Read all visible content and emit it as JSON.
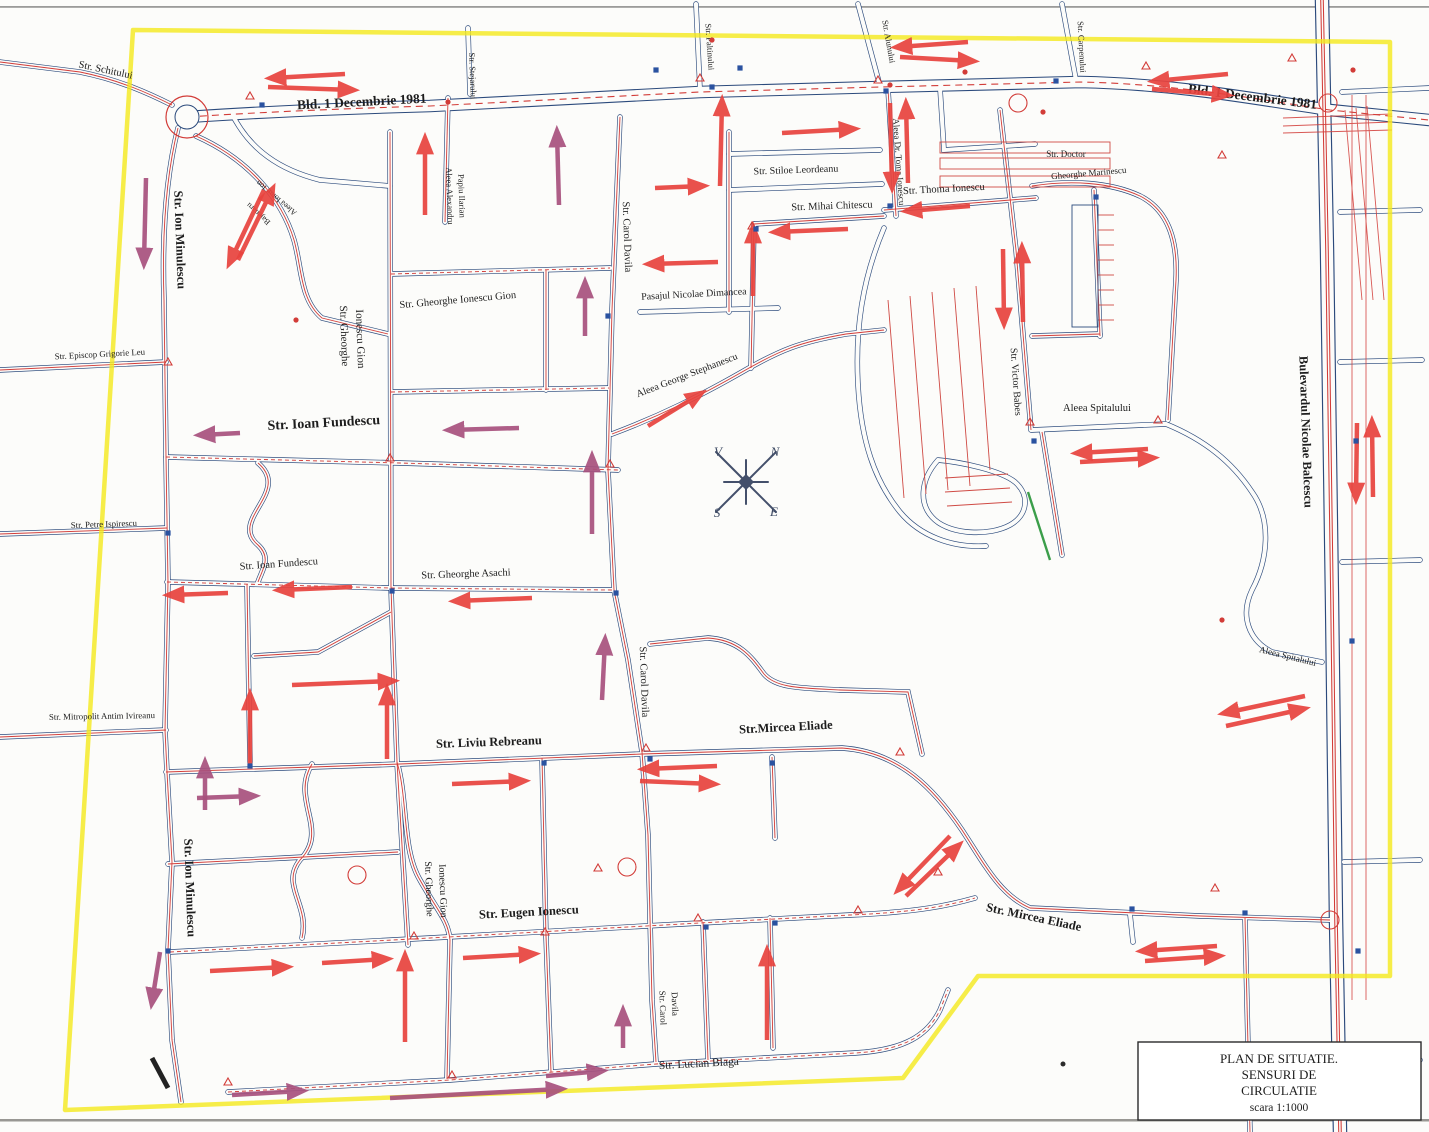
{
  "title_block": {
    "line1": "PLAN DE SITUATIE.",
    "line2": "SENSURI DE",
    "line3": "CIRCULATIE",
    "line4": "scara 1:1000"
  },
  "compass": {
    "north": "N",
    "east": "E",
    "south": "S",
    "west": "V"
  },
  "colors": {
    "boundary_highlight": "#f4e81c",
    "road_casing": "#2b4a7c",
    "road_axis_red": "#d23c38",
    "arrow_red": "#e8433e",
    "arrow_purple": "#a8517e",
    "green_marking": "#3b9e4a",
    "paper": "#fcfcfa"
  },
  "labels": [
    {
      "t": "Str. Schitului",
      "x": 105,
      "y": 73,
      "r": 12,
      "s": 10.5
    },
    {
      "t": "Bld. 1 Decembrie 1981",
      "x": 362,
      "y": 106,
      "r": -3,
      "s": 13.5
    },
    {
      "t": "Bld. 1 Decembrie 1981",
      "x": 1252,
      "y": 101,
      "r": 7,
      "s": 13.5
    },
    {
      "t": "Str. Stejarului",
      "x": 470,
      "y": 76,
      "r": 88,
      "s": 8.5
    },
    {
      "t": "Aleea Alexandru",
      "x": 447,
      "y": 196,
      "r": 88,
      "s": 8.5
    },
    {
      "t": "Papiu Ilarian",
      "x": 459,
      "y": 196,
      "r": 88,
      "s": 8.5
    },
    {
      "t": "Aleea Ionut Ion",
      "x": 278,
      "y": 196,
      "r": 220,
      "s": 8
    },
    {
      "t": "Bajenaru",
      "x": 260,
      "y": 212,
      "r": 222,
      "s": 8
    },
    {
      "t": "Str. Ion Minulescu",
      "x": 176,
      "y": 240,
      "r": 88,
      "s": 12.5
    },
    {
      "t": "Str. Ion Minulescu",
      "x": 186,
      "y": 888,
      "r": 88,
      "s": 12.5
    },
    {
      "t": "Str. Episcop Grigorie Leu",
      "x": 100,
      "y": 357,
      "r": -3,
      "s": 8.8
    },
    {
      "t": "Str. Petre Ispirescu",
      "x": 104,
      "y": 527,
      "r": -2,
      "s": 8.8
    },
    {
      "t": "Str. Mitropolit Antim Ivireanu",
      "x": 102,
      "y": 719,
      "r": -1,
      "s": 8.8
    },
    {
      "t": "Str. Ioan Fundescu",
      "x": 324,
      "y": 427,
      "r": -3,
      "s": 14
    },
    {
      "t": "Str. Ioan Fundescu",
      "x": 279,
      "y": 567,
      "r": -4,
      "s": 10.5
    },
    {
      "t": "Str. Gheorghe Asachi",
      "x": 466,
      "y": 577,
      "r": -2,
      "s": 10.5
    },
    {
      "t": "Str. Gheorghe",
      "x": 341,
      "y": 336,
      "r": 88,
      "s": 11
    },
    {
      "t": "Ionescu Gion",
      "x": 357,
      "y": 339,
      "r": 88,
      "s": 11
    },
    {
      "t": "Str. Gheorghe Ionescu Gion",
      "x": 458,
      "y": 303,
      "r": -5,
      "s": 10.5
    },
    {
      "t": "Str. Carol Davila",
      "x": 624,
      "y": 237,
      "r": 88,
      "s": 10.5
    },
    {
      "t": "Str. Carol Davila",
      "x": 641,
      "y": 682,
      "r": 88,
      "s": 10.5
    },
    {
      "t": "Str. Carol",
      "x": 660,
      "y": 1008,
      "r": 88,
      "s": 9
    },
    {
      "t": "Davila",
      "x": 672,
      "y": 1004,
      "r": 88,
      "s": 9
    },
    {
      "t": "Pasajul Nicolae Dimancea",
      "x": 694,
      "y": 297,
      "r": -3,
      "s": 10
    },
    {
      "t": "Aleea George Stephanescu",
      "x": 688,
      "y": 378,
      "r": -21,
      "s": 10
    },
    {
      "t": "Str. Stiloe Leordeanu",
      "x": 796,
      "y": 173,
      "r": -2,
      "s": 10
    },
    {
      "t": "Str. Mihai Chitescu",
      "x": 832,
      "y": 209,
      "r": -2,
      "s": 10.5
    },
    {
      "t": "Aleea Dr. Toma Ionescu",
      "x": 896,
      "y": 162,
      "r": 86,
      "s": 9
    },
    {
      "t": "Str. Thoma Ionescu",
      "x": 944,
      "y": 192,
      "r": -3,
      "s": 10.5
    },
    {
      "t": "Str. Doctor",
      "x": 1066,
      "y": 157,
      "r": 0,
      "s": 9
    },
    {
      "t": "Gheorghe Marinescu",
      "x": 1089,
      "y": 176,
      "r": -5,
      "s": 9
    },
    {
      "t": "Str. Victor Babes",
      "x": 1013,
      "y": 382,
      "r": 86,
      "s": 10
    },
    {
      "t": "Aleea Spitalului",
      "x": 1097,
      "y": 411,
      "r": 0,
      "s": 10.5
    },
    {
      "t": "Aleea Spitalului",
      "x": 1287,
      "y": 659,
      "r": 14,
      "s": 9
    },
    {
      "t": "Bulevardul Nicolae Balcescu",
      "x": 1302,
      "y": 432,
      "r": 88,
      "s": 12.5
    },
    {
      "t": "Str. Liviu Rebreanu",
      "x": 489,
      "y": 746,
      "r": -2,
      "s": 12.5
    },
    {
      "t": "Str.Mircea Eliade",
      "x": 786,
      "y": 731,
      "r": -3,
      "s": 12.5
    },
    {
      "t": "Str. Mircea Eliade",
      "x": 1033,
      "y": 921,
      "r": 12,
      "s": 12.5
    },
    {
      "t": "Str. Eugen Ionescu",
      "x": 529,
      "y": 916,
      "r": -3,
      "s": 12.5
    },
    {
      "t": "Str. Gheorghe",
      "x": 426,
      "y": 889,
      "r": 88,
      "s": 10
    },
    {
      "t": "Ionescu Gion",
      "x": 440,
      "y": 891,
      "r": 88,
      "s": 10
    },
    {
      "t": "Str. Lucian Blaga",
      "x": 699,
      "y": 1067,
      "r": -3,
      "s": 11.5
    },
    {
      "t": "Str. Paltinului",
      "x": 707,
      "y": 47,
      "r": 86,
      "s": 8.5
    },
    {
      "t": "Str. Alunului",
      "x": 886,
      "y": 42,
      "r": 80,
      "s": 8.5
    },
    {
      "t": "Str. Carpenului",
      "x": 1079,
      "y": 47,
      "r": 87,
      "s": 8.5
    }
  ],
  "arrows": [
    [
      345,
      74,
      272,
      78,
      "r"
    ],
    [
      268,
      87,
      352,
      90,
      "r"
    ],
    [
      968,
      42,
      898,
      47,
      "r"
    ],
    [
      900,
      57,
      972,
      61,
      "r"
    ],
    [
      1228,
      74,
      1155,
      81,
      "r"
    ],
    [
      1152,
      89,
      1226,
      95,
      "r"
    ],
    [
      264,
      190,
      230,
      262,
      "r"
    ],
    [
      238,
      260,
      272,
      190,
      "r"
    ],
    [
      146,
      178,
      144,
      262,
      "p"
    ],
    [
      425,
      215,
      425,
      140,
      "r"
    ],
    [
      559,
      205,
      557,
      133,
      "p"
    ],
    [
      655,
      188,
      702,
      186,
      "r"
    ],
    [
      718,
      262,
      650,
      264,
      "r"
    ],
    [
      782,
      133,
      853,
      129,
      "r"
    ],
    [
      970,
      206,
      908,
      211,
      "r"
    ],
    [
      848,
      229,
      776,
      232,
      "r"
    ],
    [
      753,
      296,
      753,
      229,
      "r"
    ],
    [
      890,
      103,
      892,
      186,
      "r"
    ],
    [
      908,
      183,
      906,
      105,
      "r"
    ],
    [
      720,
      186,
      722,
      102,
      "r"
    ],
    [
      1003,
      249,
      1004,
      322,
      "r"
    ],
    [
      1023,
      322,
      1022,
      249,
      "r"
    ],
    [
      648,
      426,
      700,
      394,
      "r"
    ],
    [
      585,
      336,
      585,
      284,
      "p"
    ],
    [
      519,
      428,
      450,
      430,
      "p"
    ],
    [
      240,
      433,
      201,
      435,
      "p"
    ],
    [
      228,
      593,
      170,
      595,
      "r"
    ],
    [
      352,
      587,
      280,
      590,
      "r"
    ],
    [
      532,
      598,
      456,
      601,
      "r"
    ],
    [
      292,
      685,
      392,
      681,
      "r"
    ],
    [
      250,
      766,
      250,
      696,
      "r"
    ],
    [
      387,
      759,
      387,
      691,
      "r"
    ],
    [
      197,
      798,
      253,
      796,
      "p"
    ],
    [
      452,
      784,
      523,
      781,
      "r"
    ],
    [
      717,
      766,
      645,
      769,
      "r"
    ],
    [
      640,
      781,
      713,
      784,
      "r"
    ],
    [
      602,
      700,
      605,
      641,
      "p"
    ],
    [
      592,
      534,
      592,
      458,
      "p"
    ],
    [
      950,
      836,
      899,
      889,
      "r"
    ],
    [
      906,
      896,
      958,
      846,
      "r"
    ],
    [
      1148,
      449,
      1078,
      453,
      "r"
    ],
    [
      1080,
      462,
      1152,
      458,
      "r"
    ],
    [
      1305,
      696,
      1225,
      713,
      "r"
    ],
    [
      1226,
      726,
      1303,
      709,
      "r"
    ],
    [
      1357,
      423,
      1356,
      497,
      "r"
    ],
    [
      1373,
      497,
      1372,
      423,
      "r"
    ],
    [
      1217,
      946,
      1143,
      951,
      "r"
    ],
    [
      1145,
      961,
      1218,
      956,
      "r"
    ],
    [
      405,
      1042,
      405,
      957,
      "r"
    ],
    [
      623,
      1048,
      623,
      1012,
      "p"
    ],
    [
      767,
      1040,
      767,
      952,
      "r"
    ],
    [
      232,
      1095,
      301,
      1091,
      "p"
    ],
    [
      390,
      1098,
      560,
      1089,
      "p"
    ],
    [
      546,
      1076,
      601,
      1071,
      "p"
    ],
    [
      160,
      952,
      152,
      1002,
      "p"
    ],
    [
      205,
      810,
      205,
      764,
      "p"
    ],
    [
      463,
      958,
      533,
      954,
      "r"
    ],
    [
      210,
      971,
      286,
      967,
      "r"
    ],
    [
      322,
      963,
      386,
      959,
      "r"
    ]
  ],
  "signs": [
    [
      "tri",
      250,
      96
    ],
    [
      "tri",
      700,
      78
    ],
    [
      "tri",
      878,
      80
    ],
    [
      "tri",
      1146,
      66
    ],
    [
      "tri",
      1292,
      58
    ],
    [
      "tri",
      168,
      362
    ],
    [
      "tri",
      390,
      458
    ],
    [
      "tri",
      610,
      464
    ],
    [
      "tri",
      646,
      748
    ],
    [
      "tri",
      900,
      752
    ],
    [
      "tri",
      1030,
      422
    ],
    [
      "tri",
      1158,
      420
    ],
    [
      "tri",
      414,
      936
    ],
    [
      "tri",
      545,
      932
    ],
    [
      "tri",
      698,
      918
    ],
    [
      "tri",
      858,
      910
    ],
    [
      "tri",
      228,
      1082
    ],
    [
      "tri",
      452,
      1075
    ],
    [
      "tri",
      752,
      226
    ],
    [
      "tri",
      1222,
      155
    ],
    [
      "tri",
      598,
      868
    ],
    [
      "tri",
      938,
      872
    ],
    [
      "tri",
      1215,
      888
    ],
    [
      "sq",
      262,
      105
    ],
    [
      "sq",
      712,
      87
    ],
    [
      "sq",
      886,
      91
    ],
    [
      "sq",
      1056,
      81
    ],
    [
      "sq",
      168,
      533
    ],
    [
      "sq",
      392,
      591
    ],
    [
      "sq",
      616,
      593
    ],
    [
      "sq",
      650,
      759
    ],
    [
      "sq",
      772,
      763
    ],
    [
      "sq",
      1034,
      441
    ],
    [
      "sq",
      544,
      763
    ],
    [
      "sq",
      706,
      927
    ],
    [
      "sq",
      775,
      923
    ],
    [
      "sq",
      1245,
      913
    ],
    [
      "sq",
      1132,
      909
    ],
    [
      "sq",
      168,
      951
    ],
    [
      "sq",
      250,
      766
    ],
    [
      "sq",
      608,
      316
    ],
    [
      "sq",
      756,
      229
    ],
    [
      "sq",
      890,
      206
    ],
    [
      "sq",
      1096,
      197
    ],
    [
      "sq",
      1358,
      951
    ],
    [
      "sq",
      1356,
      441
    ],
    [
      "sq",
      1352,
      641
    ],
    [
      "sq",
      656,
      70
    ],
    [
      "sq",
      740,
      68
    ],
    [
      "dot",
      712,
      40
    ],
    [
      "dot",
      965,
      72
    ],
    [
      "dot",
      1043,
      112
    ],
    [
      "dot",
      1353,
      70
    ],
    [
      "dot",
      296,
      320
    ],
    [
      "dot",
      1222,
      620
    ],
    [
      "dot",
      448,
      102
    ],
    [
      "dot",
      890,
      85
    ],
    [
      "circ",
      1018,
      103
    ],
    [
      "circ",
      357,
      875
    ],
    [
      "circ",
      627,
      867
    ],
    [
      "circ",
      1330,
      920
    ],
    [
      "circ",
      1328,
      103
    ]
  ]
}
